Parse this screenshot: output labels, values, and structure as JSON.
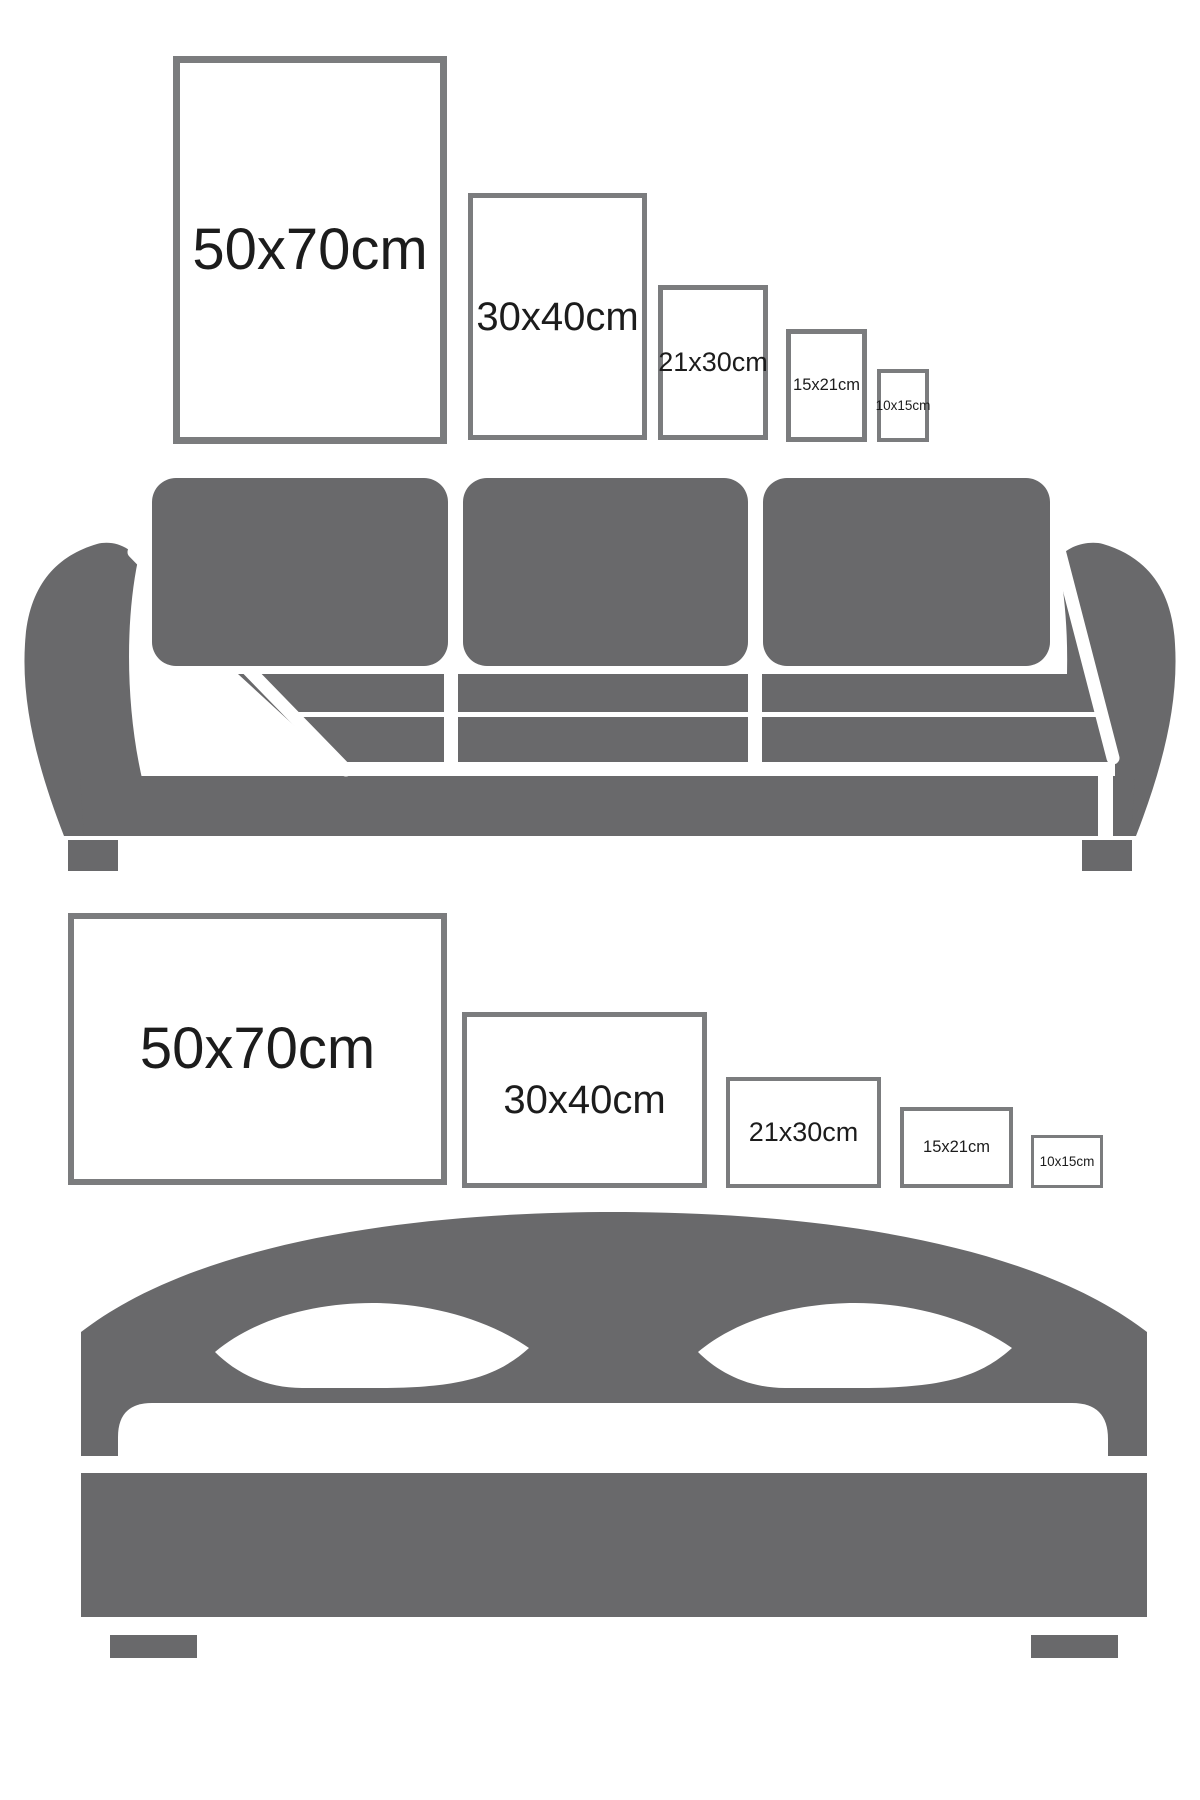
{
  "colors": {
    "background": "#ffffff",
    "furniture_gray": "#69696b",
    "frame_border_gray": "#7b7c7e",
    "label_text": "#1c1c1c"
  },
  "sofa_wall": {
    "furniture": "sofa",
    "frames": [
      {
        "label": "50x70cm",
        "orientation": "portrait"
      },
      {
        "label": "30x40cm",
        "orientation": "portrait"
      },
      {
        "label": "21x30cm",
        "orientation": "portrait"
      },
      {
        "label": "15x21cm",
        "orientation": "portrait"
      },
      {
        "label": "10x15cm",
        "orientation": "portrait"
      }
    ]
  },
  "bed_wall": {
    "furniture": "bed",
    "frames": [
      {
        "label": "50x70cm",
        "orientation": "landscape"
      },
      {
        "label": "30x40cm",
        "orientation": "landscape"
      },
      {
        "label": "21x30cm",
        "orientation": "landscape"
      },
      {
        "label": "15x21cm",
        "orientation": "landscape"
      },
      {
        "label": "10x15cm",
        "orientation": "landscape"
      }
    ]
  }
}
